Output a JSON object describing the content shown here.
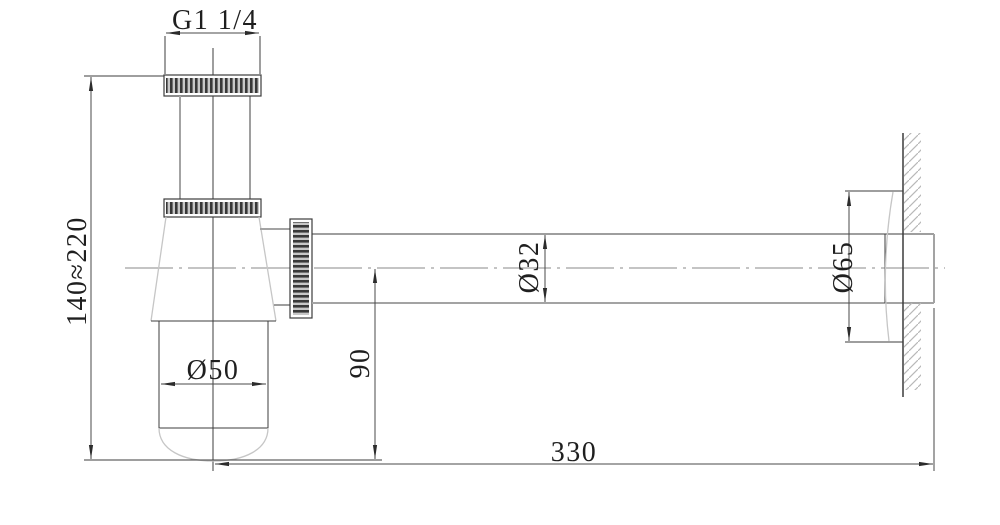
{
  "drawing": {
    "type": "technical-dimension-drawing",
    "subject": "bottle-trap-siphon-side-view",
    "labels": {
      "thread": "G1 1/4",
      "height_range": "140≈220",
      "bottle_diameter": "Ø50",
      "outlet_height": "90",
      "pipe_diameter": "Ø32",
      "flange_diameter": "Ø65",
      "wall_distance": "330"
    },
    "colors": {
      "background": "#ffffff",
      "line_dark": "#3c3c3c",
      "line_gray": "#a3a3a3",
      "line_light": "#c6c6c6",
      "knurl_dark": "#383838",
      "knurl_light": "#c7c7c7",
      "wall_hatch": "#b8b8b8",
      "text": "#1f1f1f"
    }
  }
}
